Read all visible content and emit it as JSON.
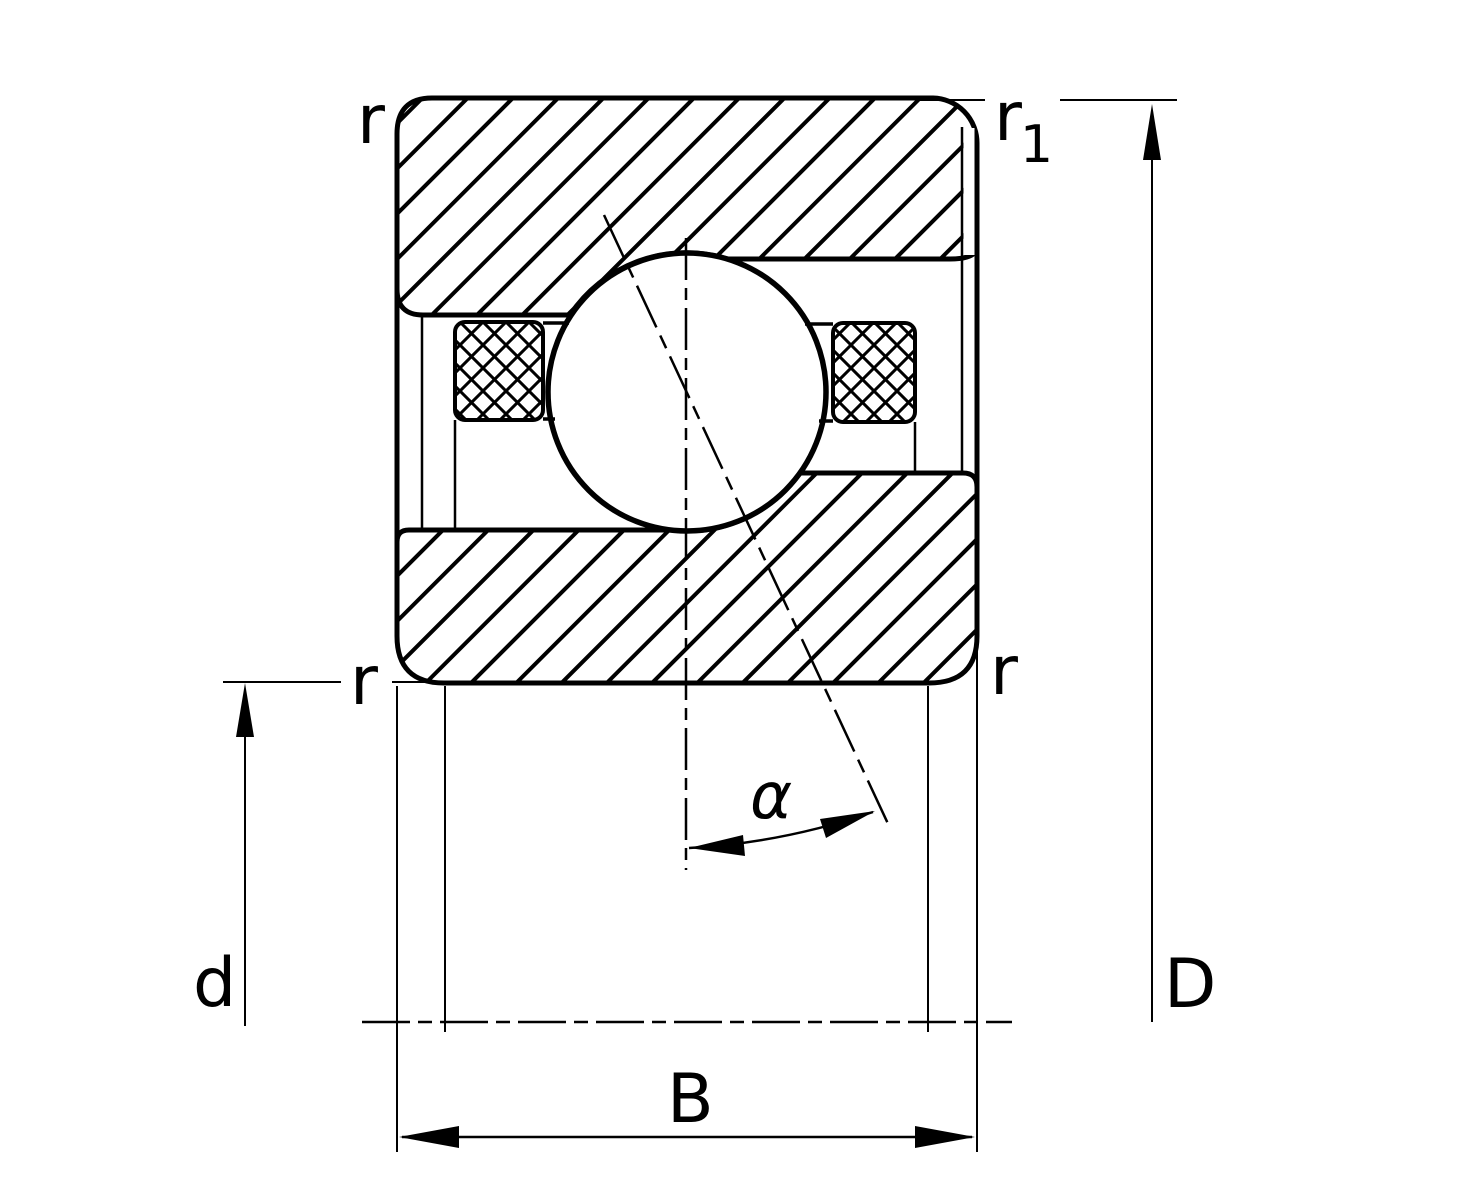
{
  "drawing": {
    "type": "bearing-cross-section",
    "ink_color": "#000000",
    "background_color": "#ffffff",
    "labels": {
      "chamfer_top_left": "r",
      "chamfer_top_right_base": "r",
      "chamfer_top_right_sub": "1",
      "chamfer_mid_left": "r",
      "chamfer_mid_right": "r",
      "bore_diameter": "d",
      "outer_diameter": "D",
      "width": "B",
      "contact_angle": "α"
    }
  }
}
